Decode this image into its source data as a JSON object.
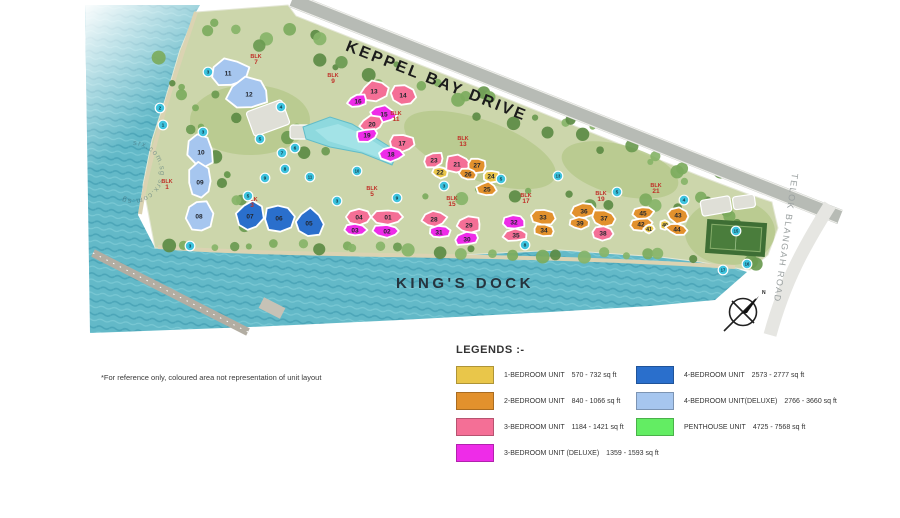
{
  "labels": {
    "road": "KEPPEL BAY DRIVE",
    "dock": "KING'S DOCK",
    "side_road": "TELOK BLANGAH ROAD",
    "watermark": "srx.com.sg srx.com.sg",
    "compass_north": "N"
  },
  "footnote": "*For reference only, coloured area not representation of unit layout",
  "legend": {
    "title": "LEGENDS :-",
    "items": [
      {
        "label": "1-BEDROOM UNIT",
        "range": "570 - 732 sq ft",
        "color": "#e9c64a"
      },
      {
        "label": "2-BEDROOM UNIT",
        "range": "840 - 1066 sq ft",
        "color": "#e2912d"
      },
      {
        "label": "3-BEDROOM UNIT",
        "range": "1184 - 1421 sq ft",
        "color": "#f46f96"
      },
      {
        "label": "3-BEDROOM UNIT (DELUXE)",
        "range": "1359 - 1593 sq ft",
        "color": "#ee2ce8"
      },
      {
        "label": "4-BEDROOM UNIT",
        "range": "2573 - 2777 sq ft",
        "color": "#2a6fcc"
      },
      {
        "label": "4-BEDROOM UNIT(DELUXE)",
        "range": "2766 - 3660 sq ft",
        "color": "#a6c6ef"
      },
      {
        "label": "PENTHOUSE UNIT",
        "range": "4725 - 7568 sq ft",
        "color": "#63ed63"
      }
    ]
  },
  "map": {
    "unit_colors": {
      "pk": "#f46f96",
      "mg": "#ee2ce8",
      "or": "#e2912d",
      "yl": "#e9c64a",
      "db": "#2a6fcc",
      "lb": "#a6c6ef"
    },
    "units": [
      {
        "n": "11",
        "x": 228,
        "y": 73,
        "c": "lb",
        "w": 40,
        "h": 30,
        "r": -15
      },
      {
        "n": "12",
        "x": 249,
        "y": 94,
        "c": "lb",
        "w": 44,
        "h": 32,
        "r": -12
      },
      {
        "n": "10",
        "x": 201,
        "y": 152,
        "c": "lb",
        "w": 34,
        "h": 25,
        "r": 78
      },
      {
        "n": "09",
        "x": 200,
        "y": 182,
        "c": "lb",
        "w": 36,
        "h": 27,
        "r": 85
      },
      {
        "n": "08",
        "x": 199,
        "y": 216,
        "c": "lb",
        "w": 34,
        "h": 26,
        "r": 80
      },
      {
        "n": "07",
        "x": 250,
        "y": 216,
        "c": "db",
        "w": 26,
        "h": 30,
        "r": 10
      },
      {
        "n": "06",
        "x": 279,
        "y": 218,
        "c": "db",
        "w": 32,
        "h": 30,
        "r": -5
      },
      {
        "n": "05",
        "x": 309,
        "y": 223,
        "c": "db",
        "w": 30,
        "h": 28,
        "r": 5
      },
      {
        "n": "04",
        "x": 359,
        "y": 217,
        "c": "pk",
        "w": 24,
        "h": 15,
        "r": 0
      },
      {
        "n": "01",
        "x": 388,
        "y": 217,
        "c": "pk",
        "w": 30,
        "h": 15,
        "r": 0
      },
      {
        "n": "03",
        "x": 355,
        "y": 230,
        "c": "mg",
        "w": 22,
        "h": 13,
        "r": 0
      },
      {
        "n": "02",
        "x": 387,
        "y": 231,
        "c": "mg",
        "w": 30,
        "h": 13,
        "r": 0
      },
      {
        "n": "13",
        "x": 374,
        "y": 91,
        "c": "pk",
        "w": 30,
        "h": 20,
        "r": -12
      },
      {
        "n": "14",
        "x": 403,
        "y": 95,
        "c": "pk",
        "w": 26,
        "h": 20,
        "r": 10
      },
      {
        "n": "16",
        "x": 358,
        "y": 101,
        "c": "mg",
        "w": 20,
        "h": 13,
        "r": -12
      },
      {
        "n": "15",
        "x": 384,
        "y": 114,
        "c": "mg",
        "w": 28,
        "h": 16,
        "r": 8
      },
      {
        "n": "20",
        "x": 372,
        "y": 124,
        "c": "pk",
        "w": 26,
        "h": 16,
        "r": -10
      },
      {
        "n": "19",
        "x": 367,
        "y": 135,
        "c": "mg",
        "w": 24,
        "h": 13,
        "r": -10
      },
      {
        "n": "17",
        "x": 402,
        "y": 143,
        "c": "pk",
        "w": 28,
        "h": 18,
        "r": 8
      },
      {
        "n": "18",
        "x": 391,
        "y": 154,
        "c": "mg",
        "w": 26,
        "h": 14,
        "r": 4
      },
      {
        "n": "23",
        "x": 434,
        "y": 160,
        "c": "pk",
        "w": 22,
        "h": 15,
        "r": -10
      },
      {
        "n": "21",
        "x": 457,
        "y": 164,
        "c": "pk",
        "w": 26,
        "h": 18,
        "r": 5
      },
      {
        "n": "22",
        "x": 440,
        "y": 172,
        "c": "yl",
        "w": 16,
        "h": 12,
        "r": -5
      },
      {
        "n": "27",
        "x": 477,
        "y": 165,
        "c": "or",
        "w": 20,
        "h": 15,
        "r": 10
      },
      {
        "n": "26",
        "x": 468,
        "y": 174,
        "c": "or",
        "w": 18,
        "h": 12,
        "r": 5
      },
      {
        "n": "24",
        "x": 491,
        "y": 176,
        "c": "yl",
        "w": 18,
        "h": 13,
        "r": 10
      },
      {
        "n": "25",
        "x": 487,
        "y": 189,
        "c": "or",
        "w": 20,
        "h": 14,
        "r": 10
      },
      {
        "n": "28",
        "x": 434,
        "y": 219,
        "c": "pk",
        "w": 24,
        "h": 17,
        "r": -8
      },
      {
        "n": "31",
        "x": 439,
        "y": 232,
        "c": "mg",
        "w": 22,
        "h": 13,
        "r": -8
      },
      {
        "n": "29",
        "x": 469,
        "y": 225,
        "c": "pk",
        "w": 26,
        "h": 16,
        "r": -5
      },
      {
        "n": "30",
        "x": 467,
        "y": 239,
        "c": "mg",
        "w": 26,
        "h": 13,
        "r": -5
      },
      {
        "n": "32",
        "x": 514,
        "y": 222,
        "c": "mg",
        "w": 24,
        "h": 15,
        "r": -8
      },
      {
        "n": "35",
        "x": 516,
        "y": 235,
        "c": "pk",
        "w": 24,
        "h": 13,
        "r": -8
      },
      {
        "n": "33",
        "x": 543,
        "y": 217,
        "c": "or",
        "w": 24,
        "h": 16,
        "r": 8
      },
      {
        "n": "34",
        "x": 544,
        "y": 230,
        "c": "or",
        "w": 24,
        "h": 13,
        "r": 8
      },
      {
        "n": "36",
        "x": 584,
        "y": 211,
        "c": "or",
        "w": 24,
        "h": 16,
        "r": -10
      },
      {
        "n": "39",
        "x": 580,
        "y": 223,
        "c": "or",
        "w": 22,
        "h": 12,
        "r": -10
      },
      {
        "n": "37",
        "x": 604,
        "y": 218,
        "c": "or",
        "w": 26,
        "h": 17,
        "r": 5
      },
      {
        "n": "38",
        "x": 603,
        "y": 233,
        "c": "pk",
        "w": 22,
        "h": 14,
        "r": 5
      },
      {
        "n": "45",
        "x": 643,
        "y": 213,
        "c": "or",
        "w": 24,
        "h": 15,
        "r": -8
      },
      {
        "n": "42",
        "x": 641,
        "y": 224,
        "c": "or",
        "w": 22,
        "h": 13,
        "r": -8
      },
      {
        "n": "41",
        "x": 649,
        "y": 229,
        "c": "yl",
        "w": 11,
        "h": 9,
        "r": 0
      },
      {
        "n": "40",
        "x": 665,
        "y": 225,
        "c": "yl",
        "w": 11,
        "h": 9,
        "r": 0
      },
      {
        "n": "43",
        "x": 678,
        "y": 215,
        "c": "or",
        "w": 26,
        "h": 16,
        "r": 8
      },
      {
        "n": "44",
        "x": 677,
        "y": 229,
        "c": "or",
        "w": 22,
        "h": 13,
        "r": 8
      }
    ],
    "blocks": [
      {
        "t": "BLK",
        "n": "1",
        "x": 167,
        "y": 183
      },
      {
        "t": "BLK",
        "n": "3",
        "x": 252,
        "y": 201
      },
      {
        "t": "BLK",
        "n": "5",
        "x": 372,
        "y": 190
      },
      {
        "t": "BLK",
        "n": "7",
        "x": 256,
        "y": 58
      },
      {
        "t": "BLK",
        "n": "9",
        "x": 333,
        "y": 77
      },
      {
        "t": "BLK",
        "n": "11",
        "x": 396,
        "y": 115
      },
      {
        "t": "BLK",
        "n": "13",
        "x": 463,
        "y": 140
      },
      {
        "t": "BLK",
        "n": "15",
        "x": 452,
        "y": 200
      },
      {
        "t": "BLK",
        "n": "17",
        "x": 526,
        "y": 197
      },
      {
        "t": "BLK",
        "n": "19",
        "x": 601,
        "y": 195
      },
      {
        "t": "BLK",
        "n": "21",
        "x": 656,
        "y": 187
      }
    ],
    "markers": [
      {
        "n": "3",
        "x": 208,
        "y": 72
      },
      {
        "n": "4",
        "x": 281,
        "y": 107
      },
      {
        "n": "2",
        "x": 160,
        "y": 108
      },
      {
        "n": "1",
        "x": 163,
        "y": 125
      },
      {
        "n": "3",
        "x": 203,
        "y": 132
      },
      {
        "n": "5",
        "x": 260,
        "y": 139
      },
      {
        "n": "6",
        "x": 295,
        "y": 148
      },
      {
        "n": "7",
        "x": 282,
        "y": 153
      },
      {
        "n": "8",
        "x": 285,
        "y": 169
      },
      {
        "n": "9",
        "x": 265,
        "y": 178
      },
      {
        "n": "11",
        "x": 310,
        "y": 177
      },
      {
        "n": "10",
        "x": 357,
        "y": 171
      },
      {
        "n": "9",
        "x": 397,
        "y": 198
      },
      {
        "n": "3",
        "x": 337,
        "y": 201
      },
      {
        "n": "5",
        "x": 248,
        "y": 196
      },
      {
        "n": "3",
        "x": 444,
        "y": 186
      },
      {
        "n": "5",
        "x": 501,
        "y": 179
      },
      {
        "n": "13",
        "x": 558,
        "y": 176
      },
      {
        "n": "8",
        "x": 525,
        "y": 245
      },
      {
        "n": "5",
        "x": 617,
        "y": 192
      },
      {
        "n": "4",
        "x": 684,
        "y": 200
      },
      {
        "n": "15",
        "x": 736,
        "y": 231
      },
      {
        "n": "16",
        "x": 747,
        "y": 264
      },
      {
        "n": "17",
        "x": 723,
        "y": 270
      },
      {
        "n": "3",
        "x": 190,
        "y": 246
      }
    ]
  }
}
